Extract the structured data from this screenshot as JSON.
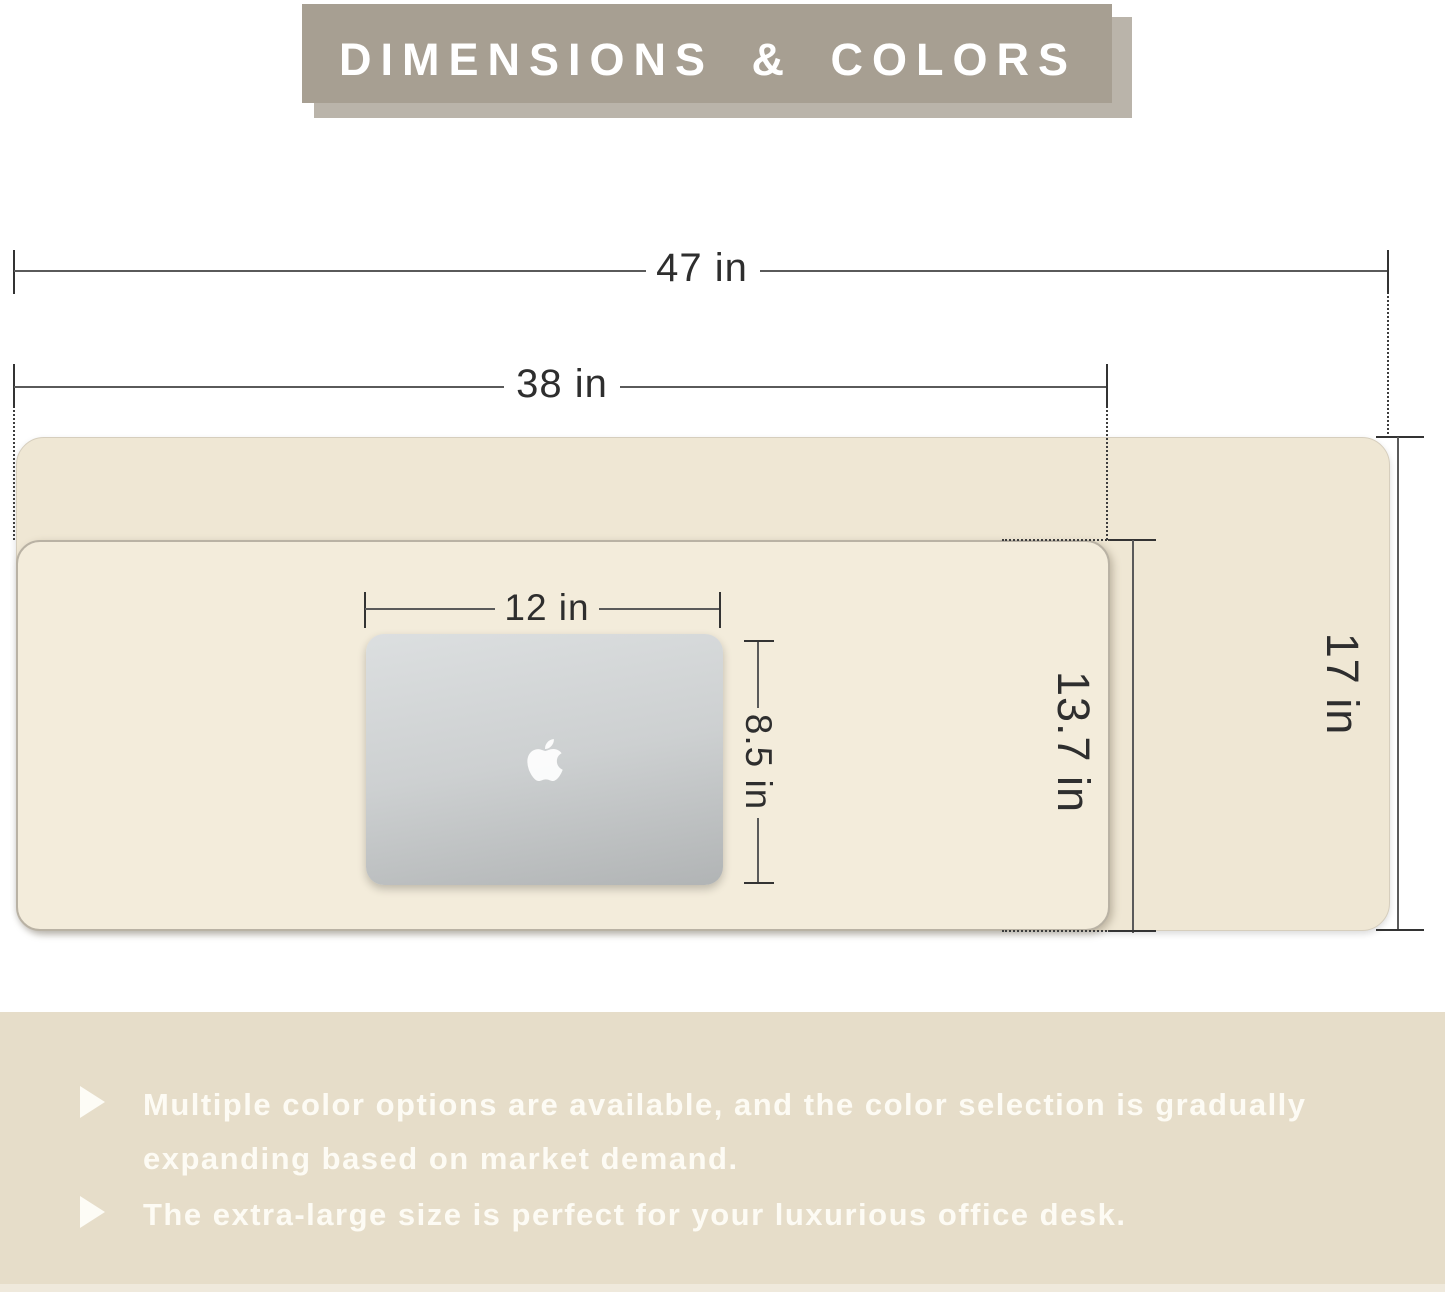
{
  "header": {
    "title": "DIMENSIONS & COLORS"
  },
  "diagram": {
    "mats": [
      {
        "name": "extra-large desk pad",
        "width_label": "47 in",
        "height_label": "17 in"
      },
      {
        "name": "large desk pad",
        "width_label": "38 in",
        "height_label": "13.7 in"
      }
    ],
    "laptop": {
      "width_label": "12 in",
      "height_label": "8.5 in"
    }
  },
  "features": {
    "items": [
      "Multiple color options are available, and the color selection is gradually expanding based on market demand.",
      "The extra-large size is perfect for your luxurious office desk."
    ]
  },
  "colors": {
    "banner_taupe": "#a79f92",
    "mat_large_beige": "#efe7d4",
    "mat_small_beige": "#f3ecdb",
    "features_bg": "#e6ddc9",
    "dimension_line": "#5a5a5a",
    "text_dark": "#2e2e2e",
    "text_light": "#fdfbf4"
  }
}
